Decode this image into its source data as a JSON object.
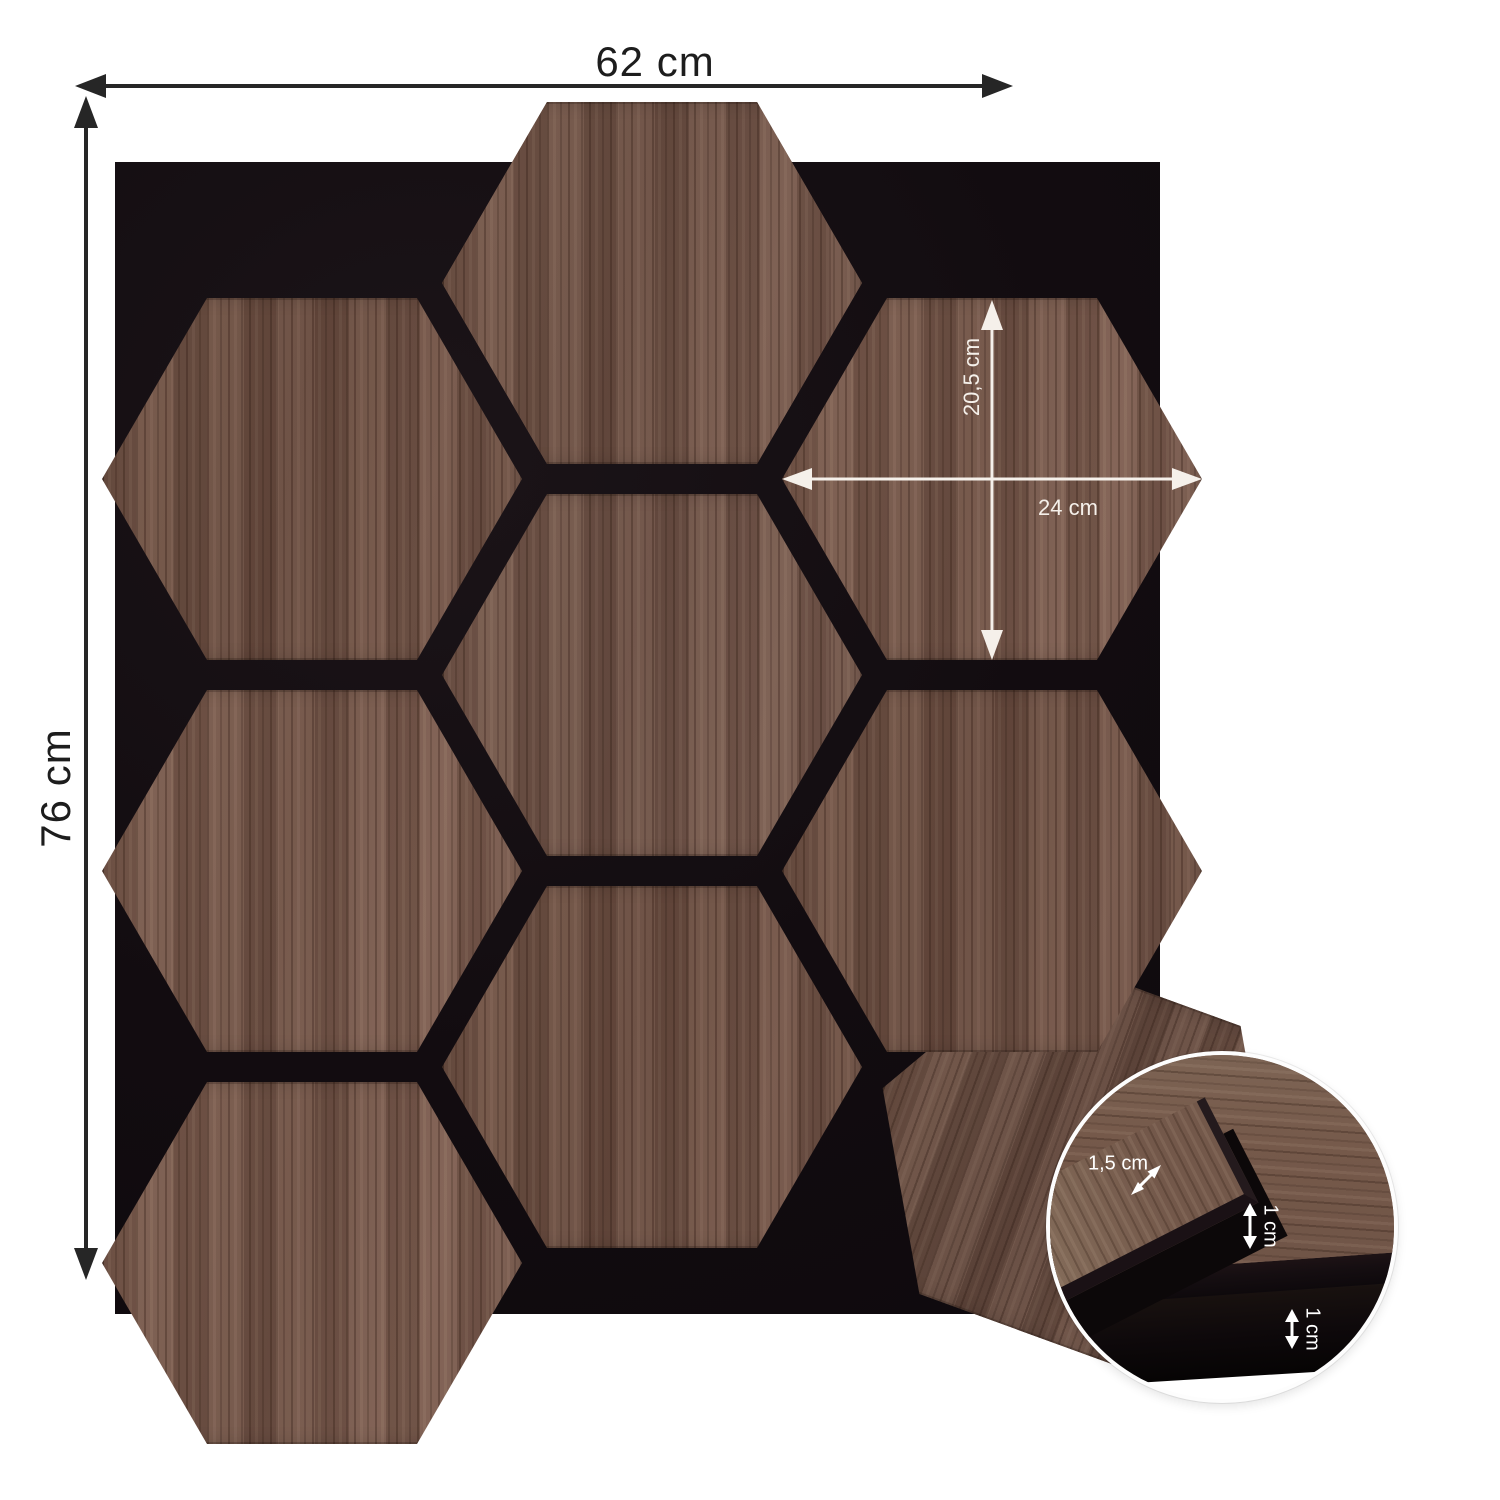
{
  "page": {
    "background": "#ffffff"
  },
  "diagram": {
    "subject": "hexagonal wood wall panels on black felt backing with dimensions",
    "overall_dimensions": {
      "width": "62 cm",
      "height": "76 cm"
    },
    "hexagon_dimensions": {
      "height": "20,5 cm",
      "width": "24 cm"
    },
    "detail_inset": {
      "panel_thickness": "1,5 cm",
      "panel_edge_thickness": "1 cm",
      "felt_thickness": "1 cm"
    },
    "colors": {
      "wood": "#6f5246",
      "felt_black": "#120d11",
      "dimension_lines_dark": "#262626",
      "dimension_lines_light": "#ffffff"
    },
    "icons": {
      "dimension_arrows": "double-headed-arrow"
    }
  }
}
